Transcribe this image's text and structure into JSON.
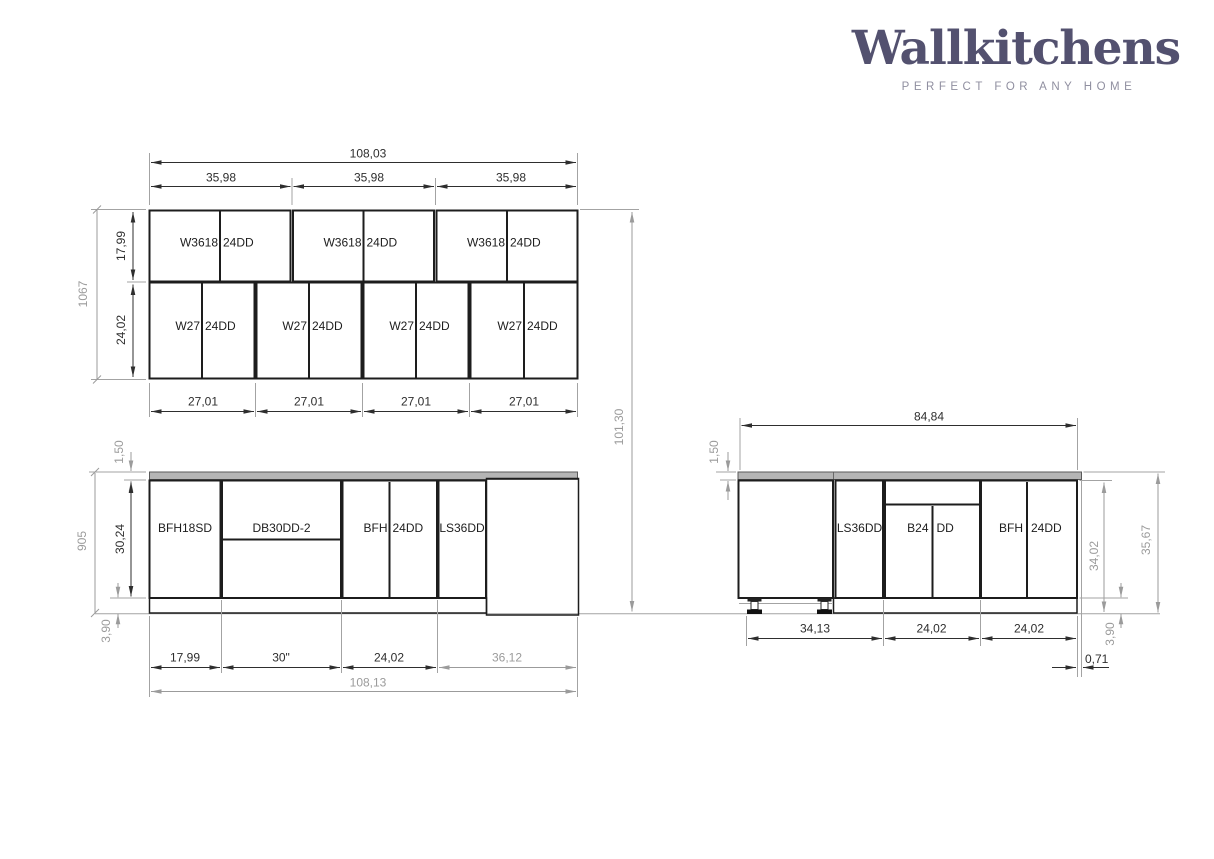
{
  "brand": {
    "name": "Wallkitchens",
    "tagline": "PERFECT FOR ANY HOME"
  },
  "wall": {
    "dim_total_width": "108,03",
    "dim_section_widths": [
      "35,98",
      "35,98",
      "35,98"
    ],
    "top_cabinets": [
      {
        "model": "W3618",
        "doors": "24DD"
      },
      {
        "model": "W3618",
        "doors": "24DD"
      },
      {
        "model": "W3618",
        "doors": "24DD"
      }
    ],
    "bottom_cabinets": [
      {
        "model": "W27",
        "doors": "24DD"
      },
      {
        "model": "W27",
        "doors": "24DD"
      },
      {
        "model": "W27",
        "doors": "24DD"
      },
      {
        "model": "W27",
        "doors": "24DD"
      }
    ],
    "dim_bottom_widths": [
      "27,01",
      "27,01",
      "27,01",
      "27,01"
    ],
    "dim_top_row_height": "17,99",
    "dim_bottom_row_height": "24,02",
    "dim_total_height_mm": "1067",
    "dim_floor_to_top": "101,30"
  },
  "base_front": {
    "dim_countertop_thickness": "1,50",
    "dim_box_height": "30,24",
    "dim_total_height_mm": "905",
    "dim_toekick_height": "3,90",
    "cabinets": [
      {
        "model": "BFH18SD"
      },
      {
        "model": "DB30DD-2"
      },
      {
        "model": "BFH",
        "doors": "24DD"
      },
      {
        "model": "LS36DD"
      }
    ],
    "dim_widths": [
      "17,99",
      "30\"",
      "24,02",
      "36,12"
    ],
    "dim_total_width": "108,13"
  },
  "base_return": {
    "dim_total_width": "84,84",
    "dim_countertop_thickness": "1,50",
    "cabinets": [
      {
        "model": "LS36DD"
      },
      {
        "model": "B24",
        "doors": "DD"
      },
      {
        "model": "BFH",
        "doors": "24DD"
      }
    ],
    "dim_widths": [
      "34,13",
      "24,02",
      "24,02"
    ],
    "dim_countertop_overhang": "0,71",
    "dim_box_height": "34,02",
    "dim_total_height": "35,67",
    "dim_toekick_height": "3,90"
  }
}
